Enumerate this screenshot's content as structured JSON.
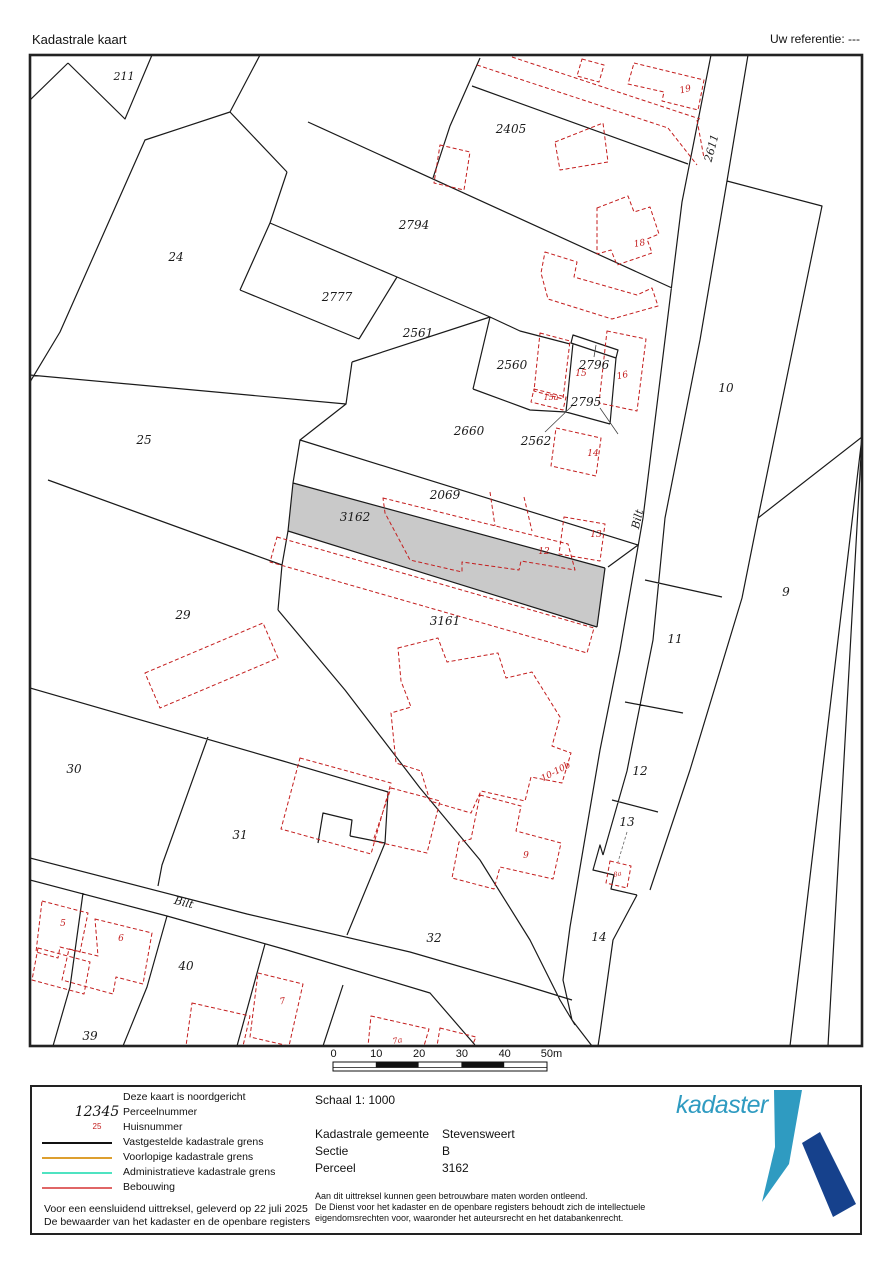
{
  "header": {
    "title": "Kadastrale kaart",
    "reference": "Uw referentie: ---"
  },
  "map": {
    "highlight_color": "#c9c9c9",
    "boundary_color": "#1a1a1a",
    "building_color": "#c41e1e",
    "highlighted_parcel": "3162",
    "labels": [
      {
        "t": "211",
        "x": 124,
        "y": 80,
        "s": 11
      },
      {
        "t": "24",
        "x": 176,
        "y": 261,
        "s": 12
      },
      {
        "t": "2794",
        "x": 414,
        "y": 229,
        "s": 12
      },
      {
        "t": "2777",
        "x": 337,
        "y": 301,
        "s": 12
      },
      {
        "t": "2405",
        "x": 511,
        "y": 133,
        "s": 12
      },
      {
        "t": "2561",
        "x": 418,
        "y": 337,
        "s": 12
      },
      {
        "t": "2560",
        "x": 512,
        "y": 369,
        "s": 12
      },
      {
        "t": "2796",
        "x": 594,
        "y": 369,
        "s": 12
      },
      {
        "t": "2795",
        "x": 586,
        "y": 406,
        "s": 12
      },
      {
        "t": "2660",
        "x": 469,
        "y": 435,
        "s": 12
      },
      {
        "t": "2562",
        "x": 536,
        "y": 445,
        "s": 12
      },
      {
        "t": "25",
        "x": 144,
        "y": 444,
        "s": 12
      },
      {
        "t": "2069",
        "x": 445,
        "y": 499,
        "s": 12
      },
      {
        "t": "3162",
        "x": 355,
        "y": 521,
        "s": 12
      },
      {
        "t": "3161",
        "x": 445,
        "y": 625,
        "s": 12
      },
      {
        "t": "29",
        "x": 183,
        "y": 619,
        "s": 12
      },
      {
        "t": "10",
        "x": 726,
        "y": 392,
        "s": 12
      },
      {
        "t": "9",
        "x": 786,
        "y": 596,
        "s": 12
      },
      {
        "t": "11",
        "x": 675,
        "y": 643,
        "s": 12
      },
      {
        "t": "12",
        "x": 640,
        "y": 775,
        "s": 12
      },
      {
        "t": "13",
        "x": 627,
        "y": 826,
        "s": 12
      },
      {
        "t": "14",
        "x": 599,
        "y": 941,
        "s": 12
      },
      {
        "t": "30",
        "x": 74,
        "y": 773,
        "s": 12
      },
      {
        "t": "31",
        "x": 240,
        "y": 839,
        "s": 12
      },
      {
        "t": "32",
        "x": 434,
        "y": 942,
        "s": 12
      },
      {
        "t": "40",
        "x": 186,
        "y": 970,
        "s": 12
      },
      {
        "t": "39",
        "x": 90,
        "y": 1040,
        "s": 12
      },
      {
        "t": "2611",
        "x": 715,
        "y": 149,
        "s": 11,
        "r": -75
      },
      {
        "t": "Bilt",
        "x": 641,
        "y": 520,
        "s": 11,
        "r": -77
      },
      {
        "t": "Bilt",
        "x": 183,
        "y": 906,
        "s": 11,
        "r": 14
      },
      {
        "t": "19",
        "x": 686,
        "y": 92,
        "s": 9,
        "r": -14,
        "c": "r"
      },
      {
        "t": "18",
        "x": 640,
        "y": 246,
        "s": 9,
        "r": -10,
        "c": "r"
      },
      {
        "t": "15",
        "x": 581,
        "y": 376,
        "s": 9,
        "c": "r"
      },
      {
        "t": "16",
        "x": 623,
        "y": 378,
        "s": 9,
        "r": -12,
        "c": "r"
      },
      {
        "t": "15a",
        "x": 551,
        "y": 400,
        "s": 8,
        "c": "r"
      },
      {
        "t": "14",
        "x": 593,
        "y": 456,
        "s": 9,
        "c": "r"
      },
      {
        "t": "13",
        "x": 596,
        "y": 537,
        "s": 9,
        "c": "r"
      },
      {
        "t": "12",
        "x": 544,
        "y": 554,
        "s": 9,
        "c": "r"
      },
      {
        "t": "10-10b",
        "x": 557,
        "y": 774,
        "s": 9,
        "r": -28,
        "c": "r"
      },
      {
        "t": "9",
        "x": 526,
        "y": 858,
        "s": 9,
        "c": "r"
      },
      {
        "t": "8a",
        "x": 618,
        "y": 876,
        "s": 6.5,
        "r": -15,
        "c": "r"
      },
      {
        "t": "5",
        "x": 63,
        "y": 926,
        "s": 9,
        "c": "r"
      },
      {
        "t": "6",
        "x": 121,
        "y": 941,
        "s": 9,
        "c": "r"
      },
      {
        "t": "7",
        "x": 283,
        "y": 1004,
        "s": 9,
        "r": -10,
        "c": "r"
      },
      {
        "t": "7a",
        "x": 398,
        "y": 1043,
        "s": 8,
        "r": -12,
        "c": "r"
      }
    ]
  },
  "scalebar": {
    "ticks": [
      "0",
      "10",
      "20",
      "30",
      "40",
      "50m"
    ]
  },
  "footer": {
    "legend": {
      "north_note": "Deze kaart is noordgericht",
      "items": [
        {
          "type": "sample-italic",
          "sample": "12345",
          "label": "Perceelnummer"
        },
        {
          "type": "sample-red",
          "sample": "25",
          "label": "Huisnummer"
        },
        {
          "type": "line",
          "color": "#111111",
          "label": "Vastgestelde kadastrale grens"
        },
        {
          "type": "line",
          "color": "#dd9f2f",
          "label": "Voorlopige kadastrale grens"
        },
        {
          "type": "line",
          "color": "#4fe3c1",
          "label": "Administratieve kadastrale grens"
        },
        {
          "type": "line",
          "color": "#e06666",
          "label": "Bebouwing"
        }
      ],
      "footnote1": "Voor een eensluidend uittreksel, geleverd op 22 juli 2025",
      "footnote2": "De bewaarder van het kadaster en de openbare registers"
    },
    "details": {
      "schaal": "Schaal 1: 1000",
      "rows": [
        {
          "label": "Kadastrale gemeente",
          "value": "Stevensweert"
        },
        {
          "label": "Sectie",
          "value": "B"
        },
        {
          "label": "Perceel",
          "value": "3162"
        }
      ],
      "disclaimer": [
        "Aan dit uittreksel kunnen geen betrouwbare maten worden ontleend.",
        "De Dienst voor het kadaster en de openbare registers behoudt zich de intellectuele",
        "eigendomsrechten voor, waaronder het auteursrecht en het databankenrecht."
      ]
    },
    "logo": {
      "text": "kadaster",
      "light_color": "#2f9bc1",
      "dark_color": "#16418c"
    }
  }
}
